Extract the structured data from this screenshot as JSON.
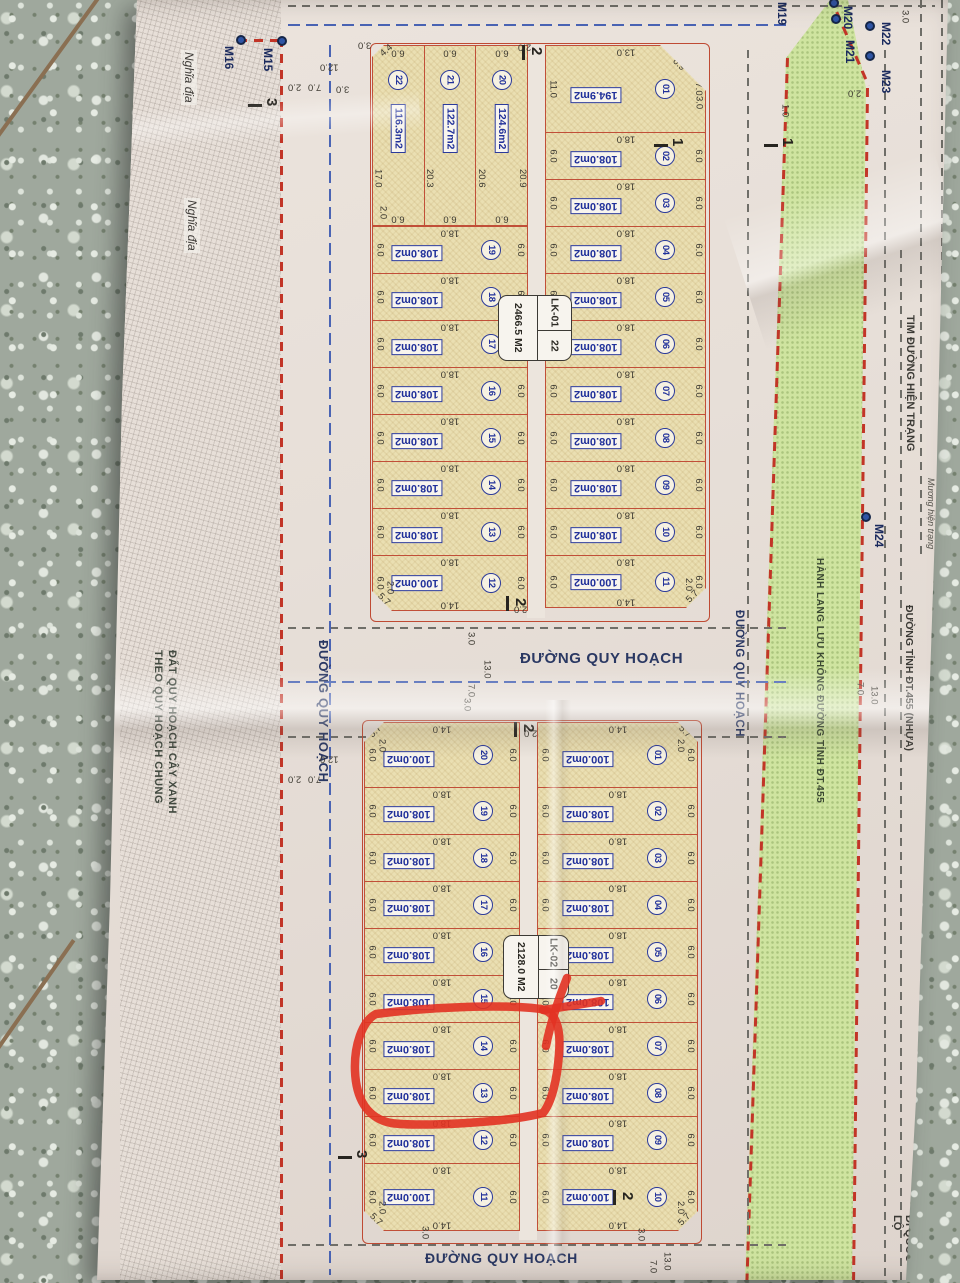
{
  "colors": {
    "paper": "#e7dfd8",
    "plot_fill": "#eadfb2",
    "plot_border": "#c14f38",
    "blue_text": "#20309a",
    "green_corridor": "#cfe4a0",
    "red_dashed": "#c23527",
    "highlight": "#e23222",
    "floor": "#9fa89d",
    "road_label": "#2a3863"
  },
  "roads": {
    "label": "ĐƯỜNG QUY HOẠCH"
  },
  "left_area": {
    "cemetery": "Nghĩa địa",
    "green_line1": "ĐẤT QUY HOẠCH CÂY XANH",
    "green_line2": "THEO QUY HOẠCH CHUNG"
  },
  "corridor_label": "HÀNH LANG LƯU KHÔNG ĐƯỜNG TỈNH ĐT.455",
  "right_area": {
    "tim": "TIM ĐƯỜNG HIỆN TRẠNG",
    "muong": "Mương hiện trạng",
    "dt455": "ĐƯỜNG TỈNH ĐT.455 (NHỰA)",
    "quocloc": "ĐI QUỐC LỘ"
  },
  "annotation": {
    "type": "hand-drawn marker circle",
    "color": "#e23222",
    "around": "plots 13 and 14 of block LK-02"
  },
  "markers": [
    {
      "id": "M16",
      "lx": 223,
      "ly": 46,
      "dx": 241,
      "dy": 40
    },
    {
      "id": "M15",
      "lx": 262,
      "ly": 48,
      "dx": 282,
      "dy": 41
    },
    {
      "id": "M19",
      "lx": 776,
      "ly": 2
    },
    {
      "id": "M20",
      "lx": 842,
      "ly": 6,
      "dx": 834,
      "dy": 3
    },
    {
      "id": "M21",
      "lx": 844,
      "ly": 40,
      "dx": 836,
      "dy": 19
    },
    {
      "id": "M22",
      "lx": 880,
      "ly": 22,
      "dx": 870,
      "dy": 26
    },
    {
      "id": "M23",
      "lx": 880,
      "ly": 70,
      "dx": 870,
      "dy": 56
    },
    {
      "id": "M24",
      "lx": 873,
      "ly": 524,
      "dx": 866,
      "dy": 517
    }
  ],
  "section_markers": [
    {
      "n": "3",
      "x": 264,
      "y": 98,
      "dir": "h"
    },
    {
      "n": "2",
      "x": 529,
      "y": 47,
      "dir": "v"
    },
    {
      "n": "1",
      "x": 670,
      "y": 138,
      "dir": "h"
    },
    {
      "n": "1",
      "x": 780,
      "y": 138,
      "dir": "h"
    },
    {
      "n": "2",
      "x": 513,
      "y": 598,
      "dir": "v"
    },
    {
      "n": "2",
      "x": 521,
      "y": 724,
      "dir": "v"
    },
    {
      "n": "3",
      "x": 354,
      "y": 1150,
      "dir": "h"
    },
    {
      "n": "2",
      "x": 620,
      "y": 1192,
      "dir": "v"
    }
  ],
  "dim_chains": [
    {
      "t": "12.0",
      "x": 320,
      "y": 62,
      "r": "r180"
    },
    {
      "t": "2.0",
      "x": 288,
      "y": 82,
      "r": "r180"
    },
    {
      "t": "7.0",
      "x": 308,
      "y": 82,
      "r": "r180"
    },
    {
      "t": "3.0",
      "x": 336,
      "y": 84,
      "r": "r180"
    },
    {
      "t": "3.0",
      "x": 358,
      "y": 40,
      "r": "r180"
    },
    {
      "t": "4.4",
      "x": 380,
      "y": 46,
      "r": "diag"
    },
    {
      "t": "2.0",
      "x": 378,
      "y": 206,
      "r": "vrl"
    },
    {
      "t": "2.0",
      "x": 518,
      "y": 42,
      "r": "r180"
    },
    {
      "t": "3.0",
      "x": 694,
      "y": 96,
      "r": "vrl"
    },
    {
      "t": "3.0",
      "x": 900,
      "y": 10,
      "r": "vrl"
    },
    {
      "t": "2.0",
      "x": 848,
      "y": 88,
      "r": "r180"
    },
    {
      "t": "1.0",
      "x": 780,
      "y": 104,
      "r": "vrl"
    },
    {
      "t": "12.0",
      "x": 320,
      "y": 754,
      "r": "r180"
    },
    {
      "t": "2.0",
      "x": 288,
      "y": 774,
      "r": "r180"
    },
    {
      "t": "7.0",
      "x": 308,
      "y": 774,
      "r": "r180"
    },
    {
      "t": "3.0",
      "x": 466,
      "y": 632,
      "r": "vrl"
    },
    {
      "t": "7.0",
      "x": 466,
      "y": 684,
      "r": "vrl"
    },
    {
      "t": "13.0",
      "x": 482,
      "y": 660,
      "r": "vrl"
    },
    {
      "t": "3.0",
      "x": 462,
      "y": 698,
      "r": "vrl"
    },
    {
      "t": "2.0",
      "x": 524,
      "y": 728,
      "r": "r180"
    },
    {
      "t": "2.0",
      "x": 514,
      "y": 604,
      "r": "r180"
    },
    {
      "t": "3.0",
      "x": 420,
      "y": 1226,
      "r": "vrl"
    },
    {
      "t": "3.0",
      "x": 636,
      "y": 1228,
      "r": "vrl"
    },
    {
      "t": "7.0",
      "x": 648,
      "y": 1260,
      "r": "vrl"
    },
    {
      "t": "13.0",
      "x": 662,
      "y": 1252,
      "r": "vrl"
    },
    {
      "t": "7.0",
      "x": 855,
      "y": 682,
      "r": "vrl"
    },
    {
      "t": "13.0",
      "x": 869,
      "y": 686,
      "r": "vrl"
    }
  ],
  "blocks": [
    {
      "name": "LK-01",
      "count": "22",
      "area_total": "2466.5 M2",
      "left_strip": [
        {
          "no": "22",
          "area": "116.3m2",
          "side": "17.0",
          "top": "6.0",
          "bottom": "6.0",
          "cpos": "tl"
        },
        {
          "no": "21",
          "area": "122.7m2",
          "side": "20.3",
          "top": "6.0",
          "bottom": "6.0"
        },
        {
          "no": "20",
          "area": "124.6m2",
          "side": "20.6",
          "side2": "20.9",
          "top": "6.0",
          "bottom": "6.0"
        }
      ],
      "left_rows": [
        {
          "no": "19",
          "area": "108.0m2",
          "top": "18.0",
          "left": "6.0",
          "right": "6.0"
        },
        {
          "no": "18",
          "area": "108.0m2",
          "top": "18.0",
          "left": "6.0",
          "right": "6.0"
        },
        {
          "no": "17",
          "area": "108.0m2",
          "top": "18.0",
          "left": "6.0",
          "right": "6.0"
        },
        {
          "no": "16",
          "area": "108.0m2",
          "top": "18.0",
          "left": "6.0",
          "right": "6.0"
        },
        {
          "no": "15",
          "area": "108.0m2",
          "top": "18.0",
          "left": "6.0",
          "right": "6.0"
        },
        {
          "no": "14",
          "area": "108.0m2",
          "top": "18.0",
          "left": "6.0",
          "right": "6.0"
        },
        {
          "no": "13",
          "area": "108.0m2",
          "top": "18.0",
          "left": "6.0",
          "right": "6.0"
        },
        {
          "no": "12",
          "area": "100.0m2",
          "top": "18.0",
          "bottom": "14.0",
          "left": "6.0",
          "right": "6.0",
          "chamfer": "5.7",
          "corner": "2.0",
          "cpos": "bl"
        }
      ],
      "right_rows": [
        {
          "no": "01",
          "area": "194.9m2",
          "top": "13.0",
          "left": "11.0",
          "right": "7.0",
          "chamfer": "6.9",
          "cpos": "tr"
        },
        {
          "no": "02",
          "area": "108.0m2",
          "top": "18.0",
          "left": "6.0",
          "right": "6.0"
        },
        {
          "no": "03",
          "area": "108.0m2",
          "top": "18.0",
          "left": "6.0",
          "right": "6.0"
        },
        {
          "no": "04",
          "area": "108.0m2",
          "top": "18.0",
          "left": "6.0",
          "right": "6.0"
        },
        {
          "no": "05",
          "area": "108.0m2",
          "top": "18.0",
          "left": "6.0",
          "right": "6.0"
        },
        {
          "no": "06",
          "area": "108.0m2",
          "top": "18.0",
          "left": "6.0",
          "right": "6.0"
        },
        {
          "no": "07",
          "area": "108.0m2",
          "top": "18.0",
          "left": "6.0",
          "right": "6.0"
        },
        {
          "no": "08",
          "area": "108.0m2",
          "top": "18.0",
          "left": "6.0",
          "right": "6.0"
        },
        {
          "no": "09",
          "area": "108.0m2",
          "top": "18.0",
          "left": "6.0",
          "right": "6.0"
        },
        {
          "no": "10",
          "area": "108.0m2",
          "top": "18.0",
          "left": "6.0",
          "right": "6.0"
        },
        {
          "no": "11",
          "area": "100.0m2",
          "top": "18.0",
          "bottom": "14.0",
          "left": "6.0",
          "right": "6.0",
          "chamfer": "5.7",
          "corner": "2.0",
          "cpos": "br"
        }
      ]
    },
    {
      "name": "LK-02",
      "count": "20",
      "area_total": "2128.0 M2",
      "left_rows": [
        {
          "no": "20",
          "area": "100.0m2",
          "top": "14.0",
          "left": "6.0",
          "right": "6.0",
          "chamfer": "5.7",
          "corner": "2.0",
          "cpos": "tl"
        },
        {
          "no": "19",
          "area": "108.0m2",
          "top": "18.0",
          "left": "6.0",
          "right": "6.0"
        },
        {
          "no": "18",
          "area": "108.0m2",
          "top": "18.0",
          "left": "6.0",
          "right": "6.0"
        },
        {
          "no": "17",
          "area": "108.0m2",
          "top": "18.0",
          "left": "6.0",
          "right": "6.0"
        },
        {
          "no": "16",
          "area": "108.0m2",
          "top": "18.0",
          "left": "6.0",
          "right": "6.0"
        },
        {
          "no": "15",
          "area": "108.0m2",
          "top": "18.0",
          "left": "6.0",
          "right": "6.0"
        },
        {
          "no": "14",
          "area": "108.0m2",
          "top": "18.0",
          "left": "6.0",
          "right": "6.0"
        },
        {
          "no": "13",
          "area": "108.0m2",
          "top": "18.0",
          "left": "6.0",
          "right": "6.0"
        },
        {
          "no": "12",
          "area": "108.0m2",
          "top": "18.0",
          "left": "6.0",
          "right": "6.0"
        },
        {
          "no": "11",
          "area": "100.0m2",
          "top": "18.0",
          "bottom": "14.0",
          "left": "6.0",
          "right": "6.0",
          "chamfer": "5.7",
          "corner": "2.0",
          "cpos": "bl"
        }
      ],
      "right_rows": [
        {
          "no": "01",
          "area": "100.0m2",
          "top": "14.0",
          "left": "6.0",
          "right": "6.0",
          "chamfer": "5.7",
          "corner": "2.0",
          "cpos": "tr"
        },
        {
          "no": "02",
          "area": "108.0m2",
          "top": "18.0",
          "left": "6.0",
          "right": "6.0"
        },
        {
          "no": "03",
          "area": "108.0m2",
          "top": "18.0",
          "left": "6.0",
          "right": "6.0"
        },
        {
          "no": "04",
          "area": "108.0m2",
          "top": "18.0",
          "left": "6.0",
          "right": "6.0"
        },
        {
          "no": "05",
          "area": "108.0m2",
          "top": "18.0",
          "left": "6.0",
          "right": "6.0"
        },
        {
          "no": "06",
          "area": "108.0m2",
          "top": "18.0",
          "left": "6.0",
          "right": "6.0"
        },
        {
          "no": "07",
          "area": "108.0m2",
          "top": "18.0",
          "left": "6.0",
          "right": "6.0"
        },
        {
          "no": "08",
          "area": "108.0m2",
          "top": "18.0",
          "left": "6.0",
          "right": "6.0"
        },
        {
          "no": "09",
          "area": "108.0m2",
          "top": "18.0",
          "left": "6.0",
          "right": "6.0"
        },
        {
          "no": "10",
          "area": "100.0m2",
          "top": "18.0",
          "bottom": "14.0",
          "left": "6.0",
          "right": "6.0",
          "chamfer": "5.7",
          "corner": "2.0",
          "cpos": "br"
        }
      ]
    }
  ]
}
